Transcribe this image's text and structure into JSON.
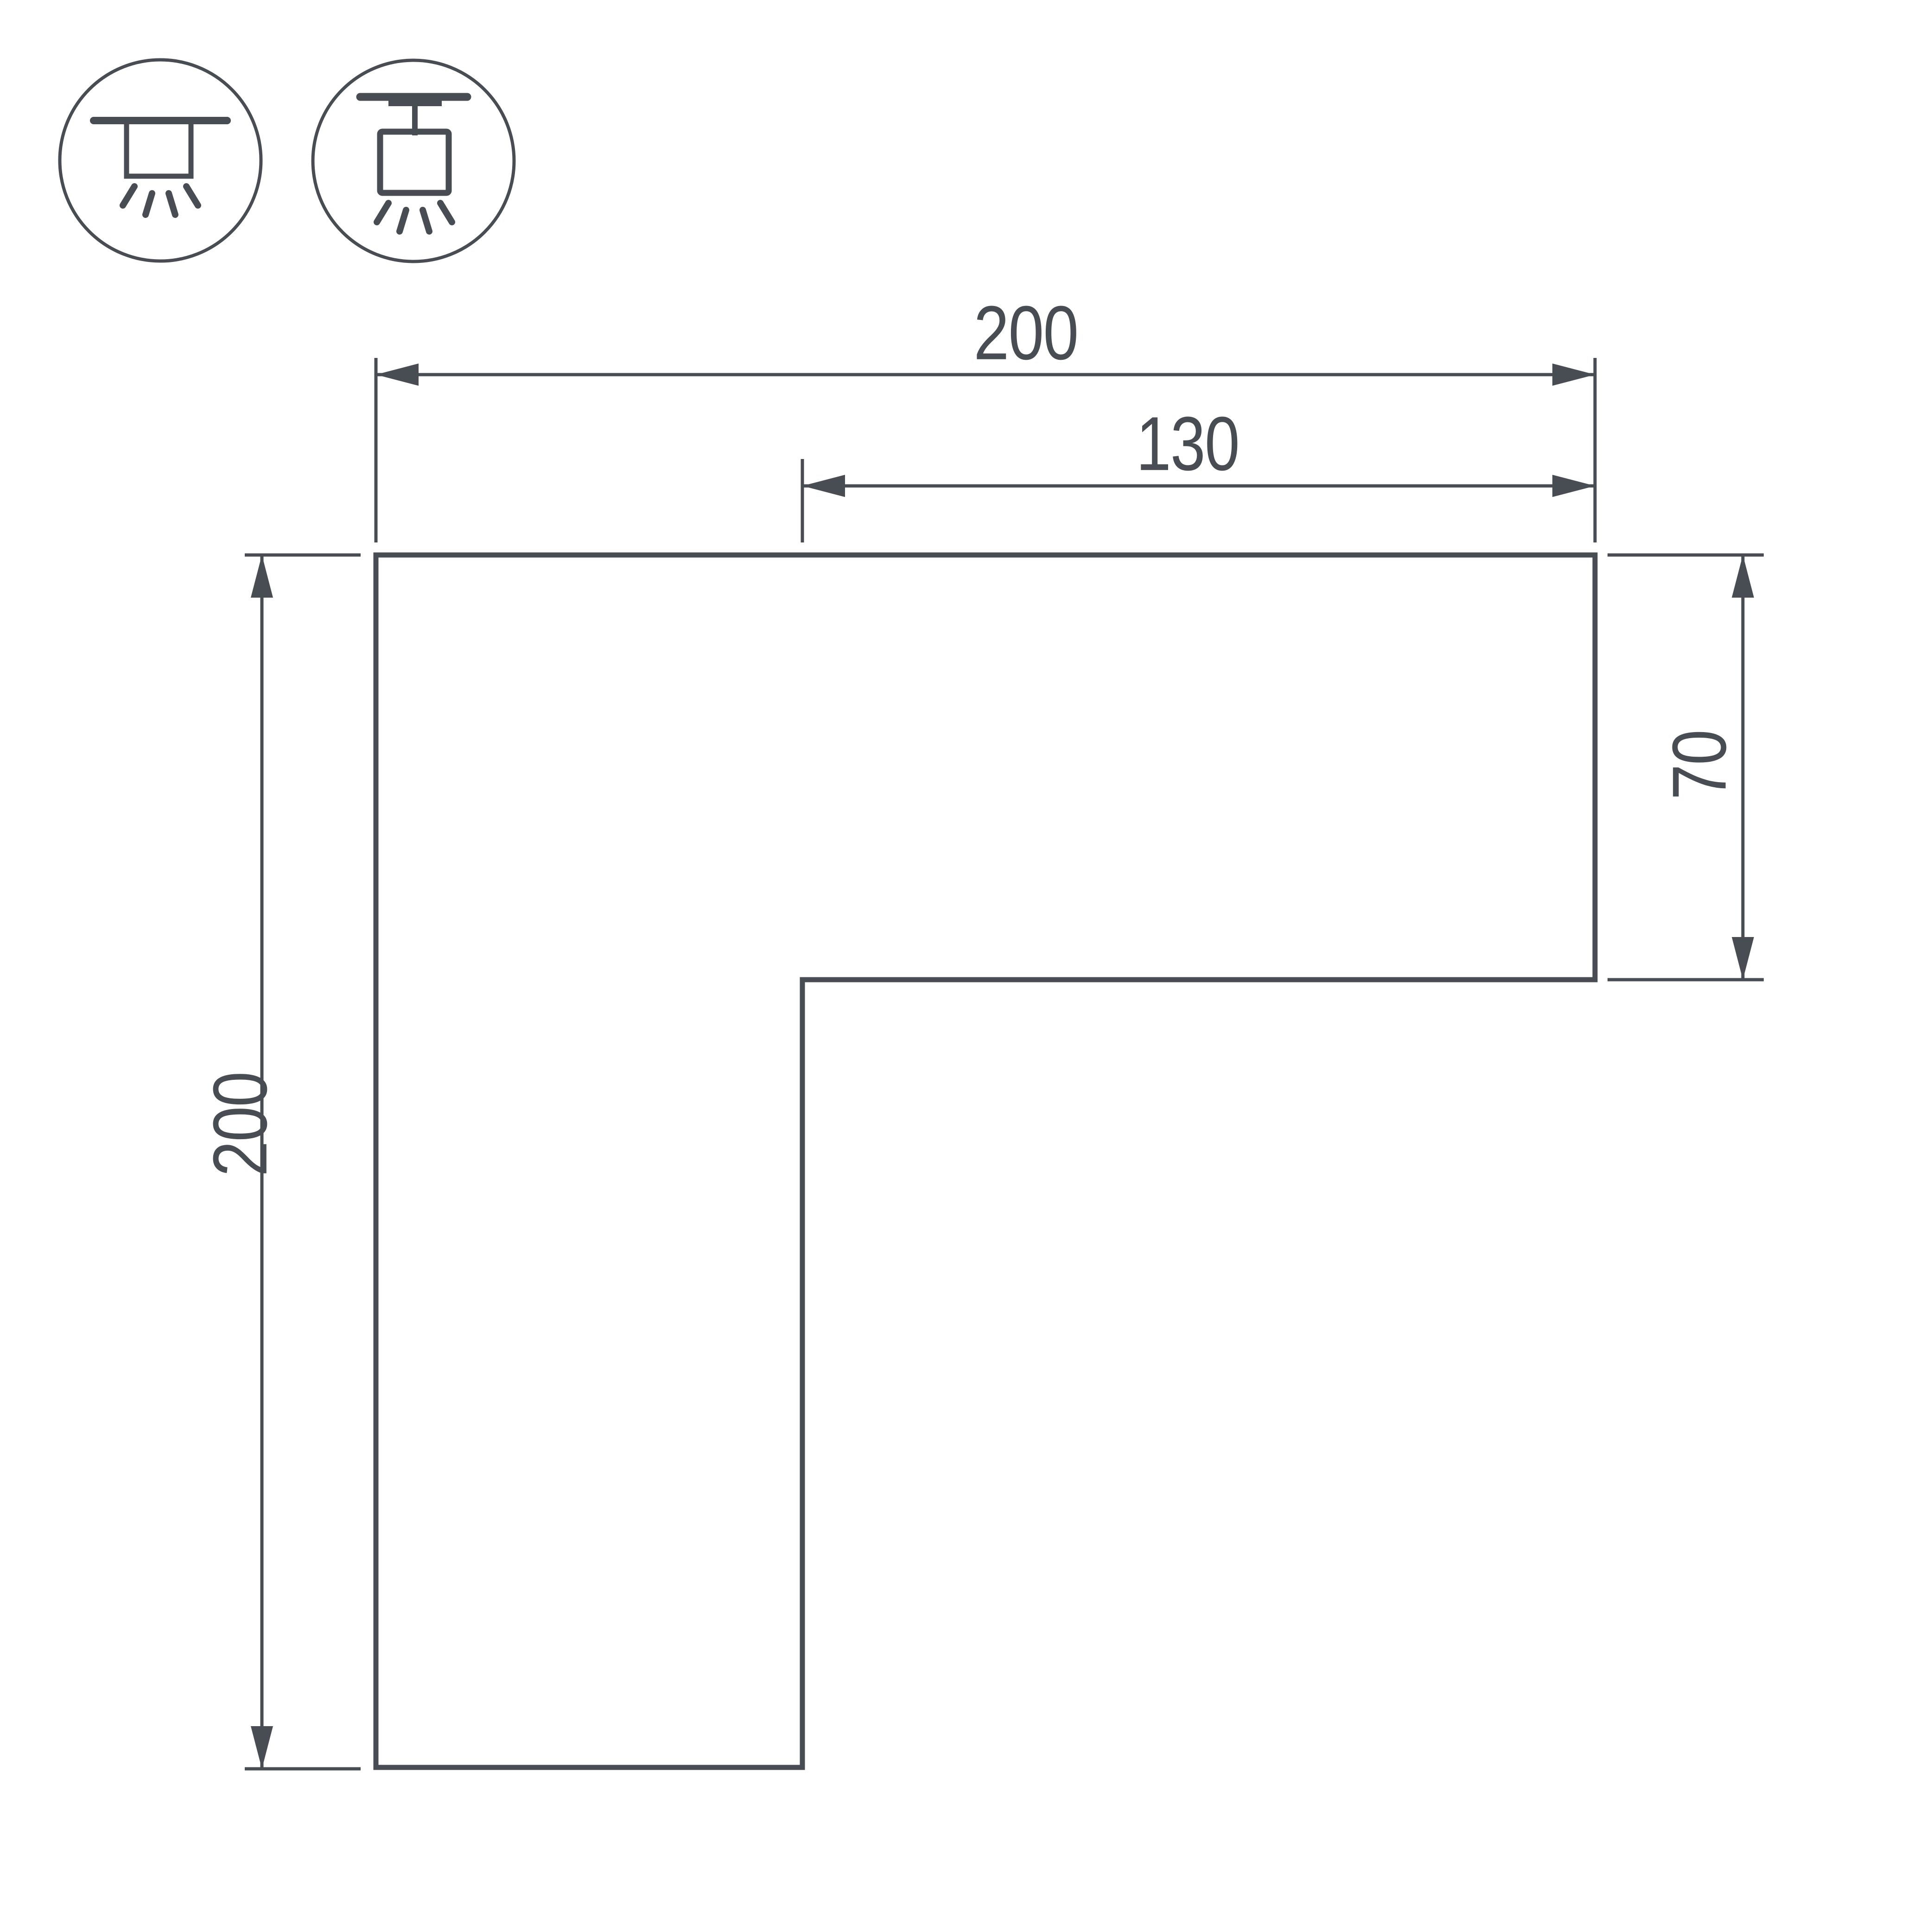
{
  "drawing": {
    "type": "technical-dimension-drawing",
    "subject": "L-shaped corner profile",
    "background_color": "#ffffff",
    "line_color": "#474d52",
    "dimensions": {
      "overall_width": "200",
      "inner_width": "130",
      "overall_height": "200",
      "right_height": "70"
    },
    "icons": [
      {
        "name": "recessed-mount-luminaire-icon",
        "meaning": "ceiling recessed mounting"
      },
      {
        "name": "track-mount-luminaire-icon",
        "meaning": "track mounting"
      }
    ]
  }
}
